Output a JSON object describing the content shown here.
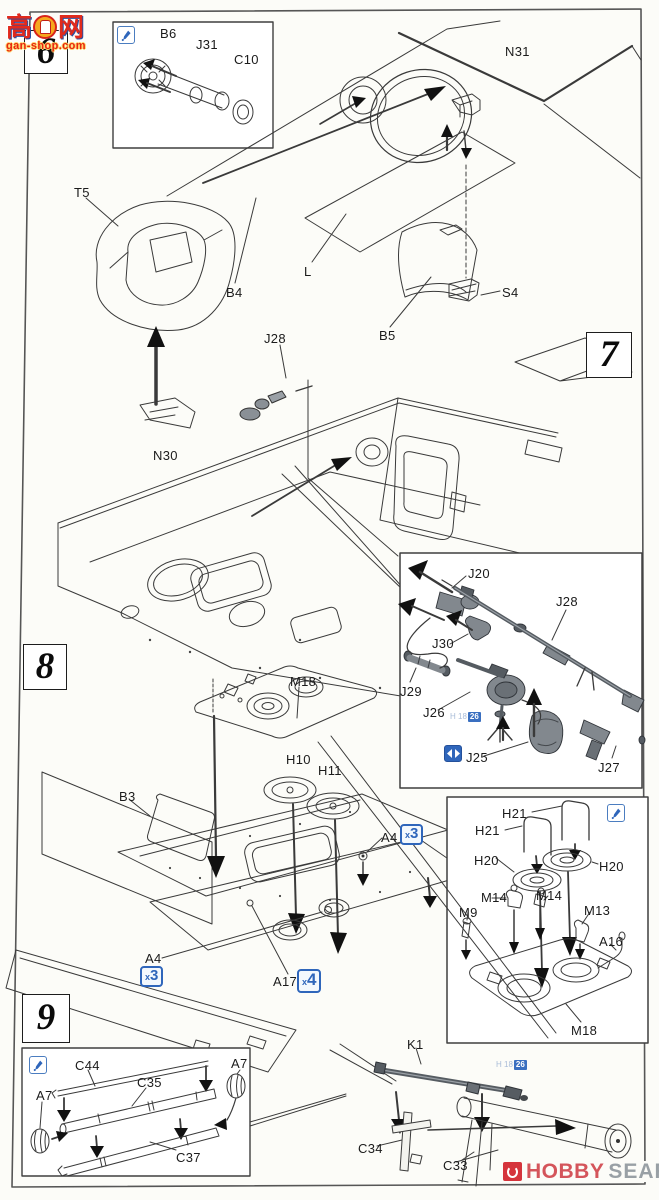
{
  "watermark": {
    "char_left": "高",
    "char_right": "网",
    "site": "gan-shop.com"
  },
  "steps": [
    {
      "number": "6"
    },
    {
      "number": "7"
    },
    {
      "number": "8"
    },
    {
      "number": "9"
    }
  ],
  "labels": {
    "B6": "B6",
    "J31": "J31",
    "C10": "C10",
    "N31": "N31",
    "T5": "T5",
    "B4": "B4",
    "L": "L",
    "B5": "B5",
    "S4": "S4",
    "J28": "J28",
    "N30": "N30",
    "J20": "J20",
    "J30": "J30",
    "J29": "J29",
    "J26": "J26",
    "J25": "J25",
    "J27": "J27",
    "M18": "M18",
    "H10": "H10",
    "H11": "H11",
    "B3": "B3",
    "A4": "A4",
    "A17": "A17",
    "H21": "H21",
    "H20": "H20",
    "M14": "M14",
    "M9": "M9",
    "M13": "M13",
    "A16": "A16",
    "C44": "C44",
    "C35": "C35",
    "C37": "C37",
    "A7": "A7",
    "K1": "K1",
    "C34": "C34",
    "C33": "C33"
  },
  "badges": {
    "x3": "x3",
    "x4": "x4"
  },
  "paint_callout": {
    "prefix": "H 18",
    "number": "26"
  },
  "footer": {
    "brand_word1": "HOBBY",
    "brand_word2": "SEARCH"
  }
}
